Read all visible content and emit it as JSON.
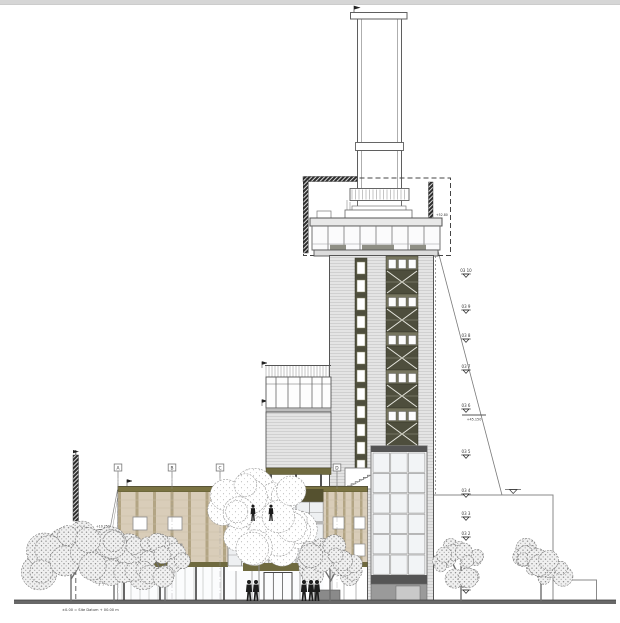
{
  "drawing": {
    "type": "architectural-elevation",
    "description": "Front elevation of a tower with tall flue stack and low podium building, trees and street level",
    "annotations": {
      "datum_note": "±0.00 = Site Datum + 00.00 m",
      "diagonal_level_note": "+45.150",
      "leader_left_note": "+10.250",
      "pavilion_note": "+52.80"
    },
    "levels": [
      {
        "label": "03 10",
        "y": 272
      },
      {
        "label": "03 9",
        "y": 308
      },
      {
        "label": "03 8",
        "y": 337
      },
      {
        "label": "03 7",
        "y": 368
      },
      {
        "label": "03 6",
        "y": 407
      },
      {
        "label": "03 5",
        "y": 453
      },
      {
        "label": "03 4",
        "y": 492
      },
      {
        "label": "03 3",
        "y": 515
      },
      {
        "label": "03 2",
        "y": 535
      },
      {
        "label": "03 1",
        "y": 562
      },
      {
        "label": "03 0",
        "y": 588
      }
    ],
    "grid_bubbles": [
      {
        "label": "A",
        "x": 118
      },
      {
        "label": "B",
        "x": 172
      },
      {
        "label": "C",
        "x": 220
      },
      {
        "label": "D",
        "x": 337
      }
    ],
    "trees": [
      {
        "x": 28,
        "w": 86,
        "top": 528,
        "style": "grey"
      },
      {
        "x": 76,
        "w": 76,
        "top": 536,
        "style": "grey"
      },
      {
        "x": 139,
        "w": 52,
        "top": 538,
        "style": "grey"
      },
      {
        "x": 210,
        "w": 98,
        "top": 477,
        "style": "light"
      },
      {
        "x": 299,
        "w": 62,
        "top": 538,
        "style": "grey"
      },
      {
        "x": 436,
        "w": 50,
        "top": 541,
        "style": "grey"
      },
      {
        "x": 514,
        "w": 54,
        "top": 546,
        "style": "grey"
      }
    ],
    "figures": {
      "mezzanine": [
        {
          "x": 253,
          "y": 521
        },
        {
          "x": 271,
          "y": 521
        }
      ],
      "ground": [
        {
          "x": 249,
          "y": 601
        },
        {
          "x": 256,
          "y": 601
        },
        {
          "x": 304,
          "y": 601
        },
        {
          "x": 311,
          "y": 601
        },
        {
          "x": 317,
          "y": 601
        }
      ]
    },
    "colors": {
      "line": "#5f5f5f",
      "olive_dark": "#55512f",
      "olive_mid": "#6f6a3f",
      "olive_roof": "#7a7342",
      "tan": "#d9cdb9",
      "tan_mullion": "#b3a584",
      "tower_grey": "#e4e4e4",
      "tower_stripe": "#cbcbcb",
      "strip_dark": "#4e4e3d",
      "glazing": "#f2f4f6",
      "ground": "#686868",
      "figure": "#1c1c1c"
    }
  }
}
